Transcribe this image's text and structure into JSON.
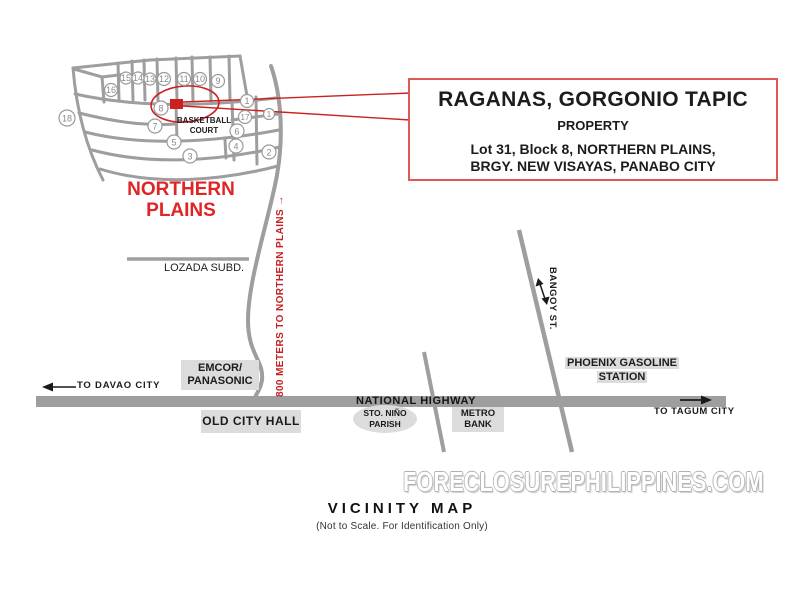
{
  "footer": {
    "watermark": "FORECLOSUREPHILIPPINES.COM",
    "map_title": "VICINITY MAP",
    "map_subtitle": "(Not to Scale. For Identification Only)"
  },
  "callout": {
    "title": "RAGANAS, GORGONIO TAPIC",
    "subtitle": "PROPERTY",
    "address_line1": "Lot 31, Block 8,  NORTHERN PLAINS,",
    "address_line2": "BRGY. NEW VISAYAS, PANABO CITY"
  },
  "subdivision": {
    "name_line1": "NORTHERN",
    "name_line2": "PLAINS",
    "court_line1": "BASKETBALL",
    "court_line2": "COURT",
    "lots": [
      "15",
      "14",
      "13",
      "12",
      "11",
      "10",
      "9",
      "16",
      "18",
      "8",
      "7",
      "5",
      "3",
      "1",
      "17",
      "1",
      "6",
      "4",
      "2"
    ]
  },
  "roads": {
    "highway_label": "NATIONAL HIGHWAY",
    "bangoy_label": "BANGOY ST.",
    "distance_label": "800 METERS TO NORTHERN PLAINS →",
    "to_west": "TO DAVAO CITY",
    "to_east": "TO TAGUM CITY"
  },
  "places": {
    "lozada": "LOZADA SUBD.",
    "emcor_line1": "EMCOR/",
    "emcor_line2": "PANASONIC",
    "old_city_hall": "OLD CITY HALL",
    "sto_nino_line1": "STO. NIÑO",
    "sto_nino_line2": "PARISH",
    "metro_line1": "METRO",
    "metro_line2": "BANK",
    "phoenix_line1": "PHOENIX GASOLINE",
    "phoenix_line2": "STATION"
  },
  "icons": {
    "west_arrow": "left-arrow",
    "east_arrow": "right-arrow",
    "bangoy_arrow": "double-headed-arrow",
    "marker": "red-square-marker"
  },
  "colors": {
    "accent_red": "#CC2020",
    "callout_border": "#E05A55",
    "road_gray": "#9E9E9E",
    "box_gray": "#DCDCDC"
  }
}
